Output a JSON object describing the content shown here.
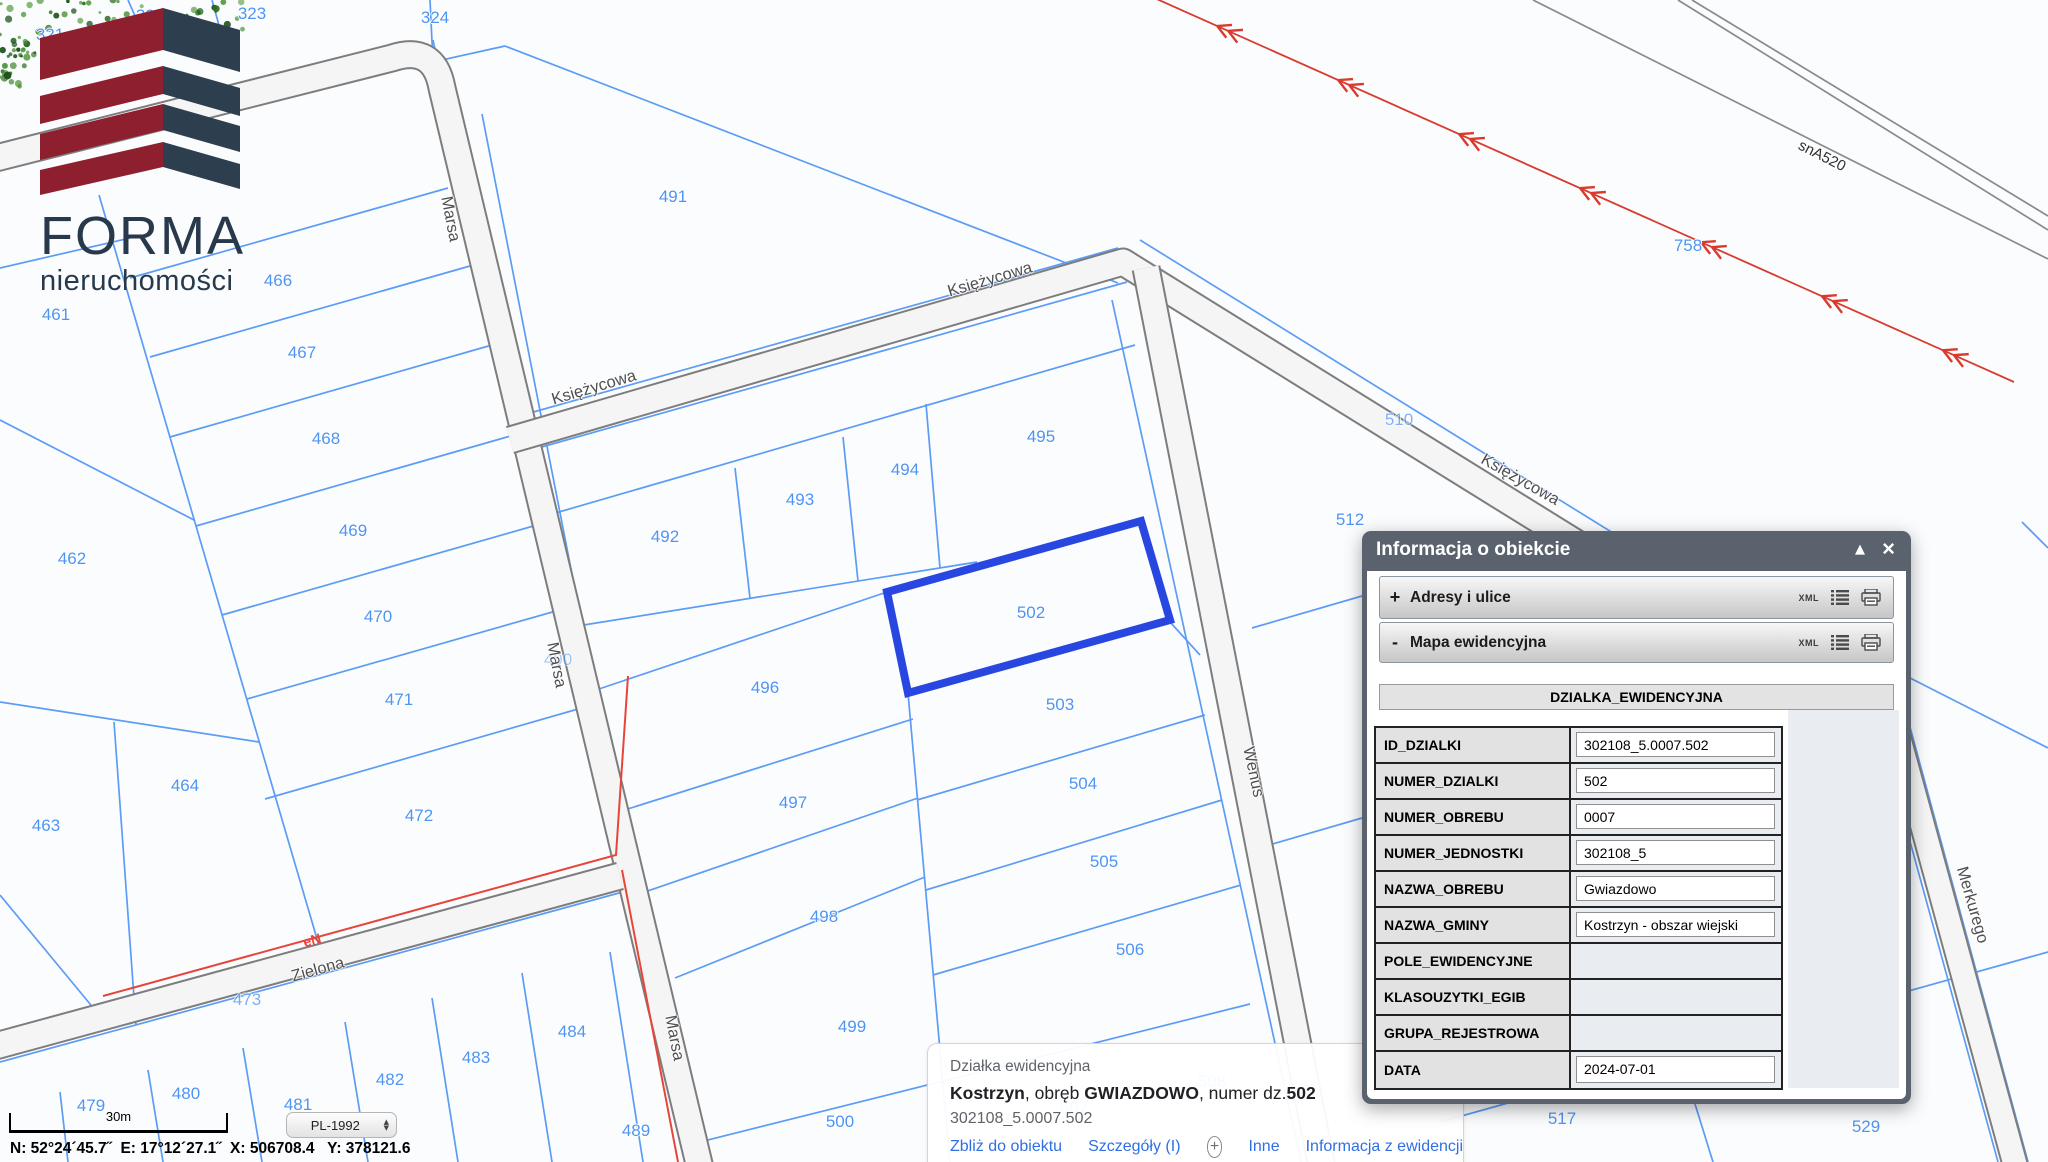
{
  "logo": {
    "title": "FORMA",
    "subtitle": "nieruchomości"
  },
  "map": {
    "highlighted_parcel": "502",
    "accent_colors": {
      "parcel_line": "#5c9cf5",
      "highlight": "#2847e0",
      "power_line": "#d93a2e",
      "road_edge": "#7d7d7d"
    },
    "parcel_labels": [
      {
        "t": "321",
        "x": 50,
        "y": 35
      },
      {
        "t": "322",
        "x": 150,
        "y": 16
      },
      {
        "t": "323",
        "x": 252,
        "y": 14
      },
      {
        "t": "324",
        "x": 435,
        "y": 18
      },
      {
        "t": "491",
        "x": 673,
        "y": 197
      },
      {
        "t": "466",
        "x": 278,
        "y": 281
      },
      {
        "t": "461",
        "x": 56,
        "y": 315
      },
      {
        "t": "467",
        "x": 302,
        "y": 353
      },
      {
        "t": "468",
        "x": 326,
        "y": 439
      },
      {
        "t": "469",
        "x": 353,
        "y": 531
      },
      {
        "t": "462",
        "x": 72,
        "y": 559
      },
      {
        "t": "470",
        "x": 378,
        "y": 617
      },
      {
        "t": "471",
        "x": 399,
        "y": 700
      },
      {
        "t": "464",
        "x": 185,
        "y": 786
      },
      {
        "t": "472",
        "x": 419,
        "y": 816
      },
      {
        "t": "463",
        "x": 46,
        "y": 826
      },
      {
        "t": "492",
        "x": 665,
        "y": 537
      },
      {
        "t": "493",
        "x": 800,
        "y": 500
      },
      {
        "t": "494",
        "x": 905,
        "y": 470
      },
      {
        "t": "495",
        "x": 1041,
        "y": 437
      },
      {
        "t": "496",
        "x": 765,
        "y": 688
      },
      {
        "t": "497",
        "x": 793,
        "y": 803
      },
      {
        "t": "498",
        "x": 824,
        "y": 917
      },
      {
        "t": "499",
        "x": 852,
        "y": 1027
      },
      {
        "t": "500",
        "x": 840,
        "y": 1122
      },
      {
        "t": "502",
        "x": 1031,
        "y": 613
      },
      {
        "t": "503",
        "x": 1060,
        "y": 705
      },
      {
        "t": "504",
        "x": 1083,
        "y": 784
      },
      {
        "t": "505",
        "x": 1104,
        "y": 862
      },
      {
        "t": "506",
        "x": 1130,
        "y": 950
      },
      {
        "t": "510",
        "x": 1399,
        "y": 420,
        "o": 0.7
      },
      {
        "t": "512",
        "x": 1350,
        "y": 520
      },
      {
        "t": "758",
        "x": 1688,
        "y": 246
      },
      {
        "t": "517",
        "x": 1562,
        "y": 1119
      },
      {
        "t": "529",
        "x": 1866,
        "y": 1127
      },
      {
        "t": "479",
        "x": 91,
        "y": 1106
      },
      {
        "t": "480",
        "x": 186,
        "y": 1094
      },
      {
        "t": "481",
        "x": 298,
        "y": 1105
      },
      {
        "t": "482",
        "x": 390,
        "y": 1080
      },
      {
        "t": "483",
        "x": 476,
        "y": 1058
      },
      {
        "t": "484",
        "x": 572,
        "y": 1032
      },
      {
        "t": "489",
        "x": 636,
        "y": 1131
      },
      {
        "t": "473",
        "x": 247,
        "y": 1000,
        "o": 0.75
      },
      {
        "t": "490",
        "x": 558,
        "y": 660,
        "o": 0.5
      },
      {
        "t": "507",
        "x": 1074,
        "y": 1108,
        "o": 0.9
      },
      {
        "t": "508",
        "x": 1212,
        "y": 1082,
        "o": 0.9
      }
    ],
    "street_labels": [
      {
        "t": "Marsa",
        "x": 450,
        "y": 219,
        "r": 79
      },
      {
        "t": "Marsa",
        "x": 556,
        "y": 665,
        "r": 79
      },
      {
        "t": "Marsa",
        "x": 674,
        "y": 1038,
        "r": 79
      },
      {
        "t": "Księżycowa",
        "x": 594,
        "y": 388,
        "r": -16.5
      },
      {
        "t": "Księżycowa",
        "x": 990,
        "y": 280,
        "r": -16.5
      },
      {
        "t": "Księżycowa",
        "x": 1520,
        "y": 480,
        "r": 29.5
      },
      {
        "t": "Wenus",
        "x": 1253,
        "y": 772,
        "r": 78
      },
      {
        "t": "Merkurego",
        "x": 1972,
        "y": 905,
        "r": 74
      },
      {
        "t": "Zielona",
        "x": 318,
        "y": 970,
        "r": -15.5
      },
      {
        "t": "snA520",
        "x": 1822,
        "y": 156,
        "r": 27,
        "cls": "dark"
      },
      {
        "t": "eN",
        "x": 312,
        "y": 940,
        "r": -15.5,
        "cls": "red"
      }
    ],
    "power_arrow_ts": [
      0.08,
      0.22,
      0.36,
      0.5,
      0.64,
      0.78,
      0.92
    ]
  },
  "panel": {
    "title": "Informacja o obiekcie",
    "controls": {
      "collapse": "▲",
      "close": "×"
    },
    "sections": [
      {
        "prefix": "+",
        "label": "Adresy i ulice",
        "xml": "XML"
      },
      {
        "prefix": "-",
        "label": "Mapa ewidencyjna",
        "xml": "XML"
      }
    ],
    "table": {
      "header": "DZIALKA_EWIDENCYJNA",
      "rows": [
        {
          "label": "ID_DZIALKI",
          "value": "302108_5.0007.502",
          "box": true
        },
        {
          "label": "NUMER_DZIALKI",
          "value": "502",
          "box": true
        },
        {
          "label": "NUMER_OBREBU",
          "value": "0007",
          "box": true
        },
        {
          "label": "NUMER_JEDNOSTKI",
          "value": "302108_5",
          "box": true
        },
        {
          "label": "NAZWA_OBREBU",
          "value": "Gwiazdowo",
          "box": true
        },
        {
          "label": "NAZWA_GMINY",
          "value": "Kostrzyn - obszar wiejski",
          "box": true
        },
        {
          "label": "POLE_EWIDENCYJNE",
          "value": "",
          "box": false
        },
        {
          "label": "KLASOUZYTKI_EGIB",
          "value": "",
          "box": false
        },
        {
          "label": "GRUPA_REJESTROWA",
          "value": "",
          "box": false
        },
        {
          "label": "DATA",
          "value": "2024-07-01",
          "box": true
        }
      ]
    }
  },
  "popup": {
    "kind": "Działka ewidencyjna",
    "title_parts": [
      {
        "text": "Kostrzyn",
        "bold": true
      },
      {
        "text": ", obręb ",
        "bold": false
      },
      {
        "text": "GWIAZDOWO",
        "bold": true
      },
      {
        "text": ", numer dz.",
        "bold": false
      },
      {
        "text": "502",
        "bold": true
      }
    ],
    "id_line": "302108_5.0007.502",
    "links": [
      "Zbliż do obiektu",
      "Szczegóły (I)",
      "Inne",
      "Informacja z ewidencji"
    ]
  },
  "statusbar": {
    "scale_label": "30m",
    "crs": "PL-1992",
    "coords": "N: 52°24´45.7˝  E: 17°12´27.1˝  X: 506708.4   Y: 378121.6"
  }
}
